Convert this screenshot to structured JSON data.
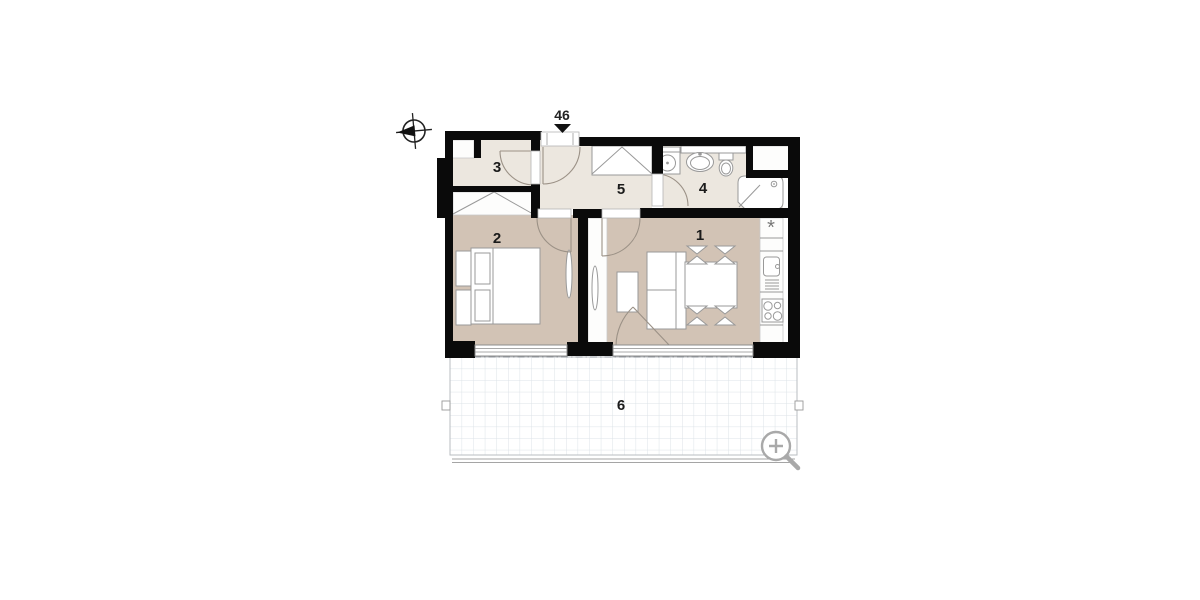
{
  "floorplan": {
    "unit_label": "46",
    "room_labels": {
      "living": "1",
      "bedroom": "2",
      "storage": "3",
      "bathroom": "4",
      "hall": "5",
      "terrace": "6"
    },
    "symbols": {
      "fridge": "*"
    },
    "icons": {
      "north_arrow": "compass-icon",
      "entrance_marker": "entrance-arrow-icon",
      "magnifier": "zoom-in-icon"
    },
    "colors": {
      "wall": "#0a0a0a",
      "warm_floor": "#d2c3b5",
      "light_floor": "#ece7df",
      "furniture_outline": "#999999",
      "door_arc": "#9b9186",
      "terrace_grid": "#dce2e7",
      "magnifier": "#a9a9a9"
    }
  }
}
